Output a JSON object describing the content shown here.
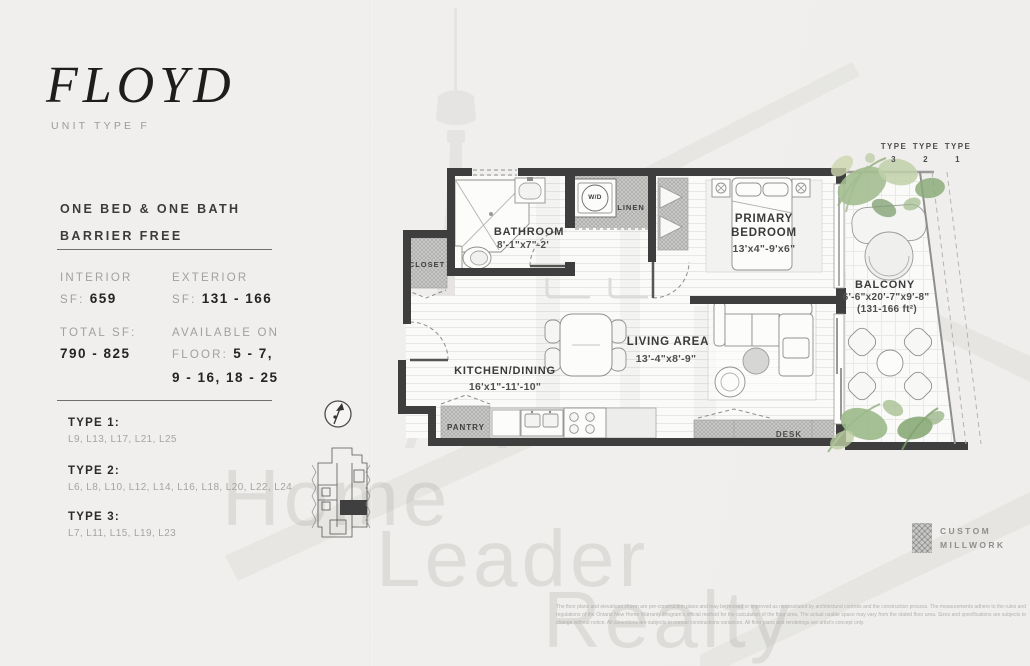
{
  "colors": {
    "paper": "#f0efed",
    "wall": "#3e3e3e",
    "accent_dark": "#1d1d1d",
    "label_gray": "#a1a09e",
    "value_dark": "#242424",
    "millwork_hatch": "#c7c7c5",
    "watermark": "#dddcd9",
    "plant_green": "#9cb989"
  },
  "header": {
    "title": "FLOYD",
    "subtitle": "UNIT TYPE F"
  },
  "summary": {
    "line1": "ONE BED & ONE BATH",
    "line2": "BARRIER FREE"
  },
  "stats": {
    "interior_label": "INTERIOR",
    "interior_sf_label": "SF:",
    "interior_value": "659",
    "exterior_label": "EXTERIOR",
    "exterior_sf_label": "SF:",
    "exterior_value": "131 - 166",
    "total_label": "TOTAL SF:",
    "total_value": "790 - 825",
    "available_label": "AVAILABLE ON",
    "floor_label": "FLOOR:",
    "floor_line1": "5 - 7,",
    "floor_line2": "9 - 16, 18 - 25"
  },
  "types": [
    {
      "label": "TYPE 1:",
      "levels": "L9, L13, L17, L21, L25"
    },
    {
      "label": "TYPE 2:",
      "levels": "L6, L8, L10, L12, L14, L16, L18, L20, L22, L24"
    },
    {
      "label": "TYPE 3:",
      "levels": "L7, L11, L15, L19, L23"
    }
  ],
  "plan": {
    "bathroom": {
      "name": "BATHROOM",
      "dims": "8'-1\"x7\"-2'"
    },
    "primary_bedroom": {
      "name_line1": "PRIMARY",
      "name_line2": "BEDROOM",
      "dims": "13'x4\"-9'x6\""
    },
    "living_area": {
      "name": "LIVING AREA",
      "dims": "13'-4\"x8'-9\""
    },
    "kitchen_dining": {
      "name": "KITCHEN/DINING",
      "dims": "16'x1\"-11'-10\""
    },
    "balcony": {
      "name": "BALCONY",
      "dims": "6'-6\"x20'-7\"x9'-8\"",
      "area": "(131-166 ft²)"
    },
    "labels": {
      "closet": "CLOSET",
      "wd": "W/D",
      "linen": "LINEN",
      "pantry": "PANTRY",
      "desk": "DESK"
    },
    "type_markers": [
      {
        "word": "TYPE",
        "num": "3"
      },
      {
        "word": "TYPE",
        "num": "2"
      },
      {
        "word": "TYPE",
        "num": "1"
      }
    ]
  },
  "legend": {
    "line1": "CUSTOM",
    "line2": "MILLWORK"
  },
  "watermark": {
    "word1": "Home",
    "word2": "Leader",
    "word3": "Realty"
  },
  "disclaimer": "The floor plans and elevations shown are pre-construction plans and may be revised or improved as necessitated by architectural controls and the construction process. The measurements adhere to the rules and regulations of the Ontario New Home Warranty Program's official method for the calculation of the floor area.  The actual usable space may vary from the stated floor area. Sizes and specifications are subjects to change without notice. All dimentions are subjects to normal constructions variances. All floor plans and renderings are artist's concept only."
}
